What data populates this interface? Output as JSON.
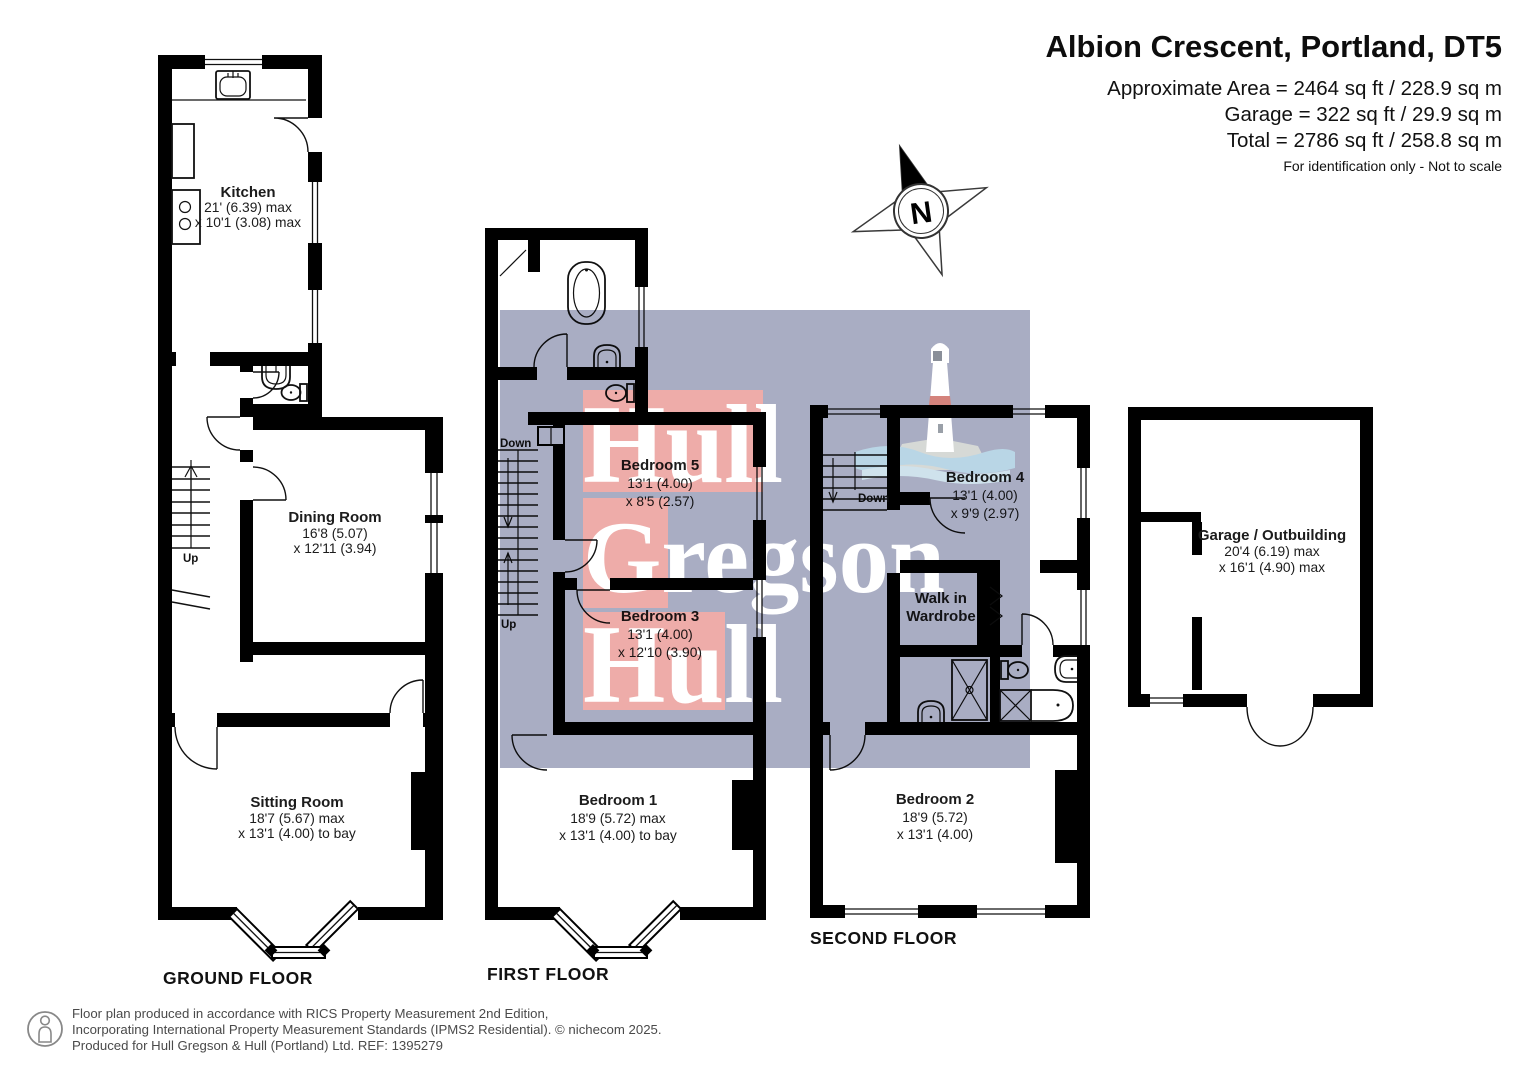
{
  "header": {
    "title": "Albion Crescent, Portland, DT5",
    "area_line1": "Approximate Area = 2464 sq ft / 228.9 sq m",
    "area_line2": "Garage = 322 sq ft / 29.9 sq m",
    "area_line3": "Total = 2786 sq ft / 258.8 sq m",
    "note": "For identification only - Not to scale"
  },
  "compass": {
    "north": "N"
  },
  "watermark": {
    "word1": "Hull",
    "word2": "Gregson",
    "word3": "Hull"
  },
  "colors": {
    "wall": "#000000",
    "watermark_bg": "#a9adc3",
    "watermark_block": "#eeaca9",
    "lighthouse_band": "#d4837c",
    "wave": "#b9d6e6"
  },
  "ground_floor": {
    "label": "GROUND FLOOR",
    "kitchen": {
      "name": "Kitchen",
      "dim1": "21' (6.39) max",
      "dim2": "x 10'1 (3.08) max"
    },
    "dining_room": {
      "name": "Dining Room",
      "dim1": "16'8 (5.07)",
      "dim2": "x 12'11 (3.94)"
    },
    "sitting_room": {
      "name": "Sitting Room",
      "dim1": "18'7 (5.67) max",
      "dim2": "x 13'1 (4.00) to bay"
    },
    "stairs": {
      "up": "Up"
    }
  },
  "first_floor": {
    "label": "FIRST FLOOR",
    "bedroom5": {
      "name": "Bedroom 5",
      "dim1": "13'1 (4.00)",
      "dim2": "x 8'5 (2.57)"
    },
    "bedroom3": {
      "name": "Bedroom 3",
      "dim1": "13'1 (4.00)",
      "dim2": "x 12'10 (3.90)"
    },
    "bedroom1": {
      "name": "Bedroom 1",
      "dim1": "18'9 (5.72) max",
      "dim2": "x 13'1 (4.00) to bay"
    },
    "stairs": {
      "down": "Down",
      "up": "Up"
    }
  },
  "second_floor": {
    "label": "SECOND FLOOR",
    "bedroom4": {
      "name": "Bedroom 4",
      "dim1": "13'1 (4.00)",
      "dim2": "x 9'9 (2.97)"
    },
    "walk_in_wardrobe": {
      "name1": "Walk in",
      "name2": "Wardrobe"
    },
    "bedroom2": {
      "name": "Bedroom 2",
      "dim1": "18'9 (5.72)",
      "dim2": "x 13'1 (4.00)"
    },
    "stairs": {
      "down": "Down"
    }
  },
  "garage": {
    "name": "Garage / Outbuilding",
    "dim1": "20'4 (6.19) max",
    "dim2": "x 16'1 (4.90) max"
  },
  "footer": {
    "line1": "Floor plan produced in accordance with RICS Property Measurement 2nd Edition,",
    "line2": "Incorporating International Property Measurement Standards (IPMS2 Residential).    © nichecom 2025.",
    "line3": "Produced for Hull Gregson & Hull (Portland) Ltd.    REF: 1395279"
  }
}
